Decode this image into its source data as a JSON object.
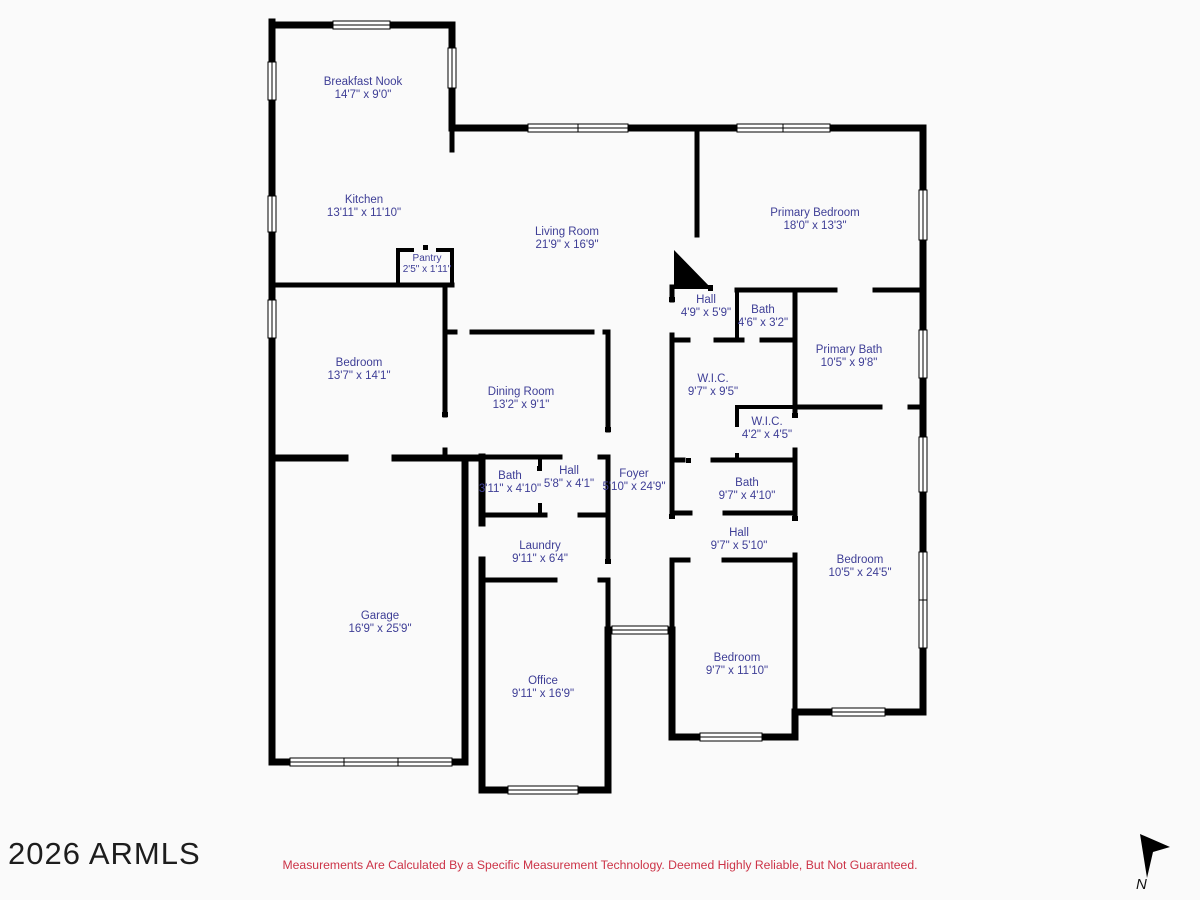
{
  "plan": {
    "label_color": "#3e3e96",
    "wall_color": "#000000",
    "rooms": [
      {
        "name": "Breakfast Nook",
        "dims": "14'7\" x 9'0\""
      },
      {
        "name": "Kitchen",
        "dims": "13'11\" x 11'10\""
      },
      {
        "name": "Pantry",
        "dims": "2'5\" x 1'11\""
      },
      {
        "name": "Living Room",
        "dims": "21'9\" x 16'9\""
      },
      {
        "name": "Primary Bedroom",
        "dims": "18'0\" x 13'3\""
      },
      {
        "name": "Hall",
        "dims": "4'9\" x 5'9\""
      },
      {
        "name": "Bath",
        "dims": "4'6\" x 3'2\""
      },
      {
        "name": "Primary Bath",
        "dims": "10'5\" x 9'8\""
      },
      {
        "name": "Bedroom",
        "dims": "13'7\" x 14'1\""
      },
      {
        "name": "Dining Room",
        "dims": "13'2\" x 9'1\""
      },
      {
        "name": "W.I.C.",
        "dims": "9'7\" x 9'5\""
      },
      {
        "name": "W.I.C.",
        "dims": "4'2\" x 4'5\""
      },
      {
        "name": "Bath",
        "dims": "3'11\" x 4'10\""
      },
      {
        "name": "Hall",
        "dims": "5'8\" x 4'1\""
      },
      {
        "name": "Foyer",
        "dims": "5'10\" x 24'9\""
      },
      {
        "name": "Bath",
        "dims": "9'7\" x 4'10\""
      },
      {
        "name": "Hall",
        "dims": "9'7\" x 5'10\""
      },
      {
        "name": "Bedroom",
        "dims": "10'5\" x 24'5\""
      },
      {
        "name": "Laundry",
        "dims": "9'11\" x 6'4\""
      },
      {
        "name": "Garage",
        "dims": "16'9\" x 25'9\""
      },
      {
        "name": "Office",
        "dims": "9'11\" x 16'9\""
      },
      {
        "name": "Bedroom",
        "dims": "9'7\" x 11'10\""
      }
    ]
  },
  "footer": {
    "watermark": "2026 ARMLS",
    "disclaimer": "Measurements Are Calculated By a Specific Measurement Technology. Deemed Highly Reliable, But Not Guaranteed.",
    "disclaimer_color": "#cc3347",
    "compass_label": "N"
  }
}
